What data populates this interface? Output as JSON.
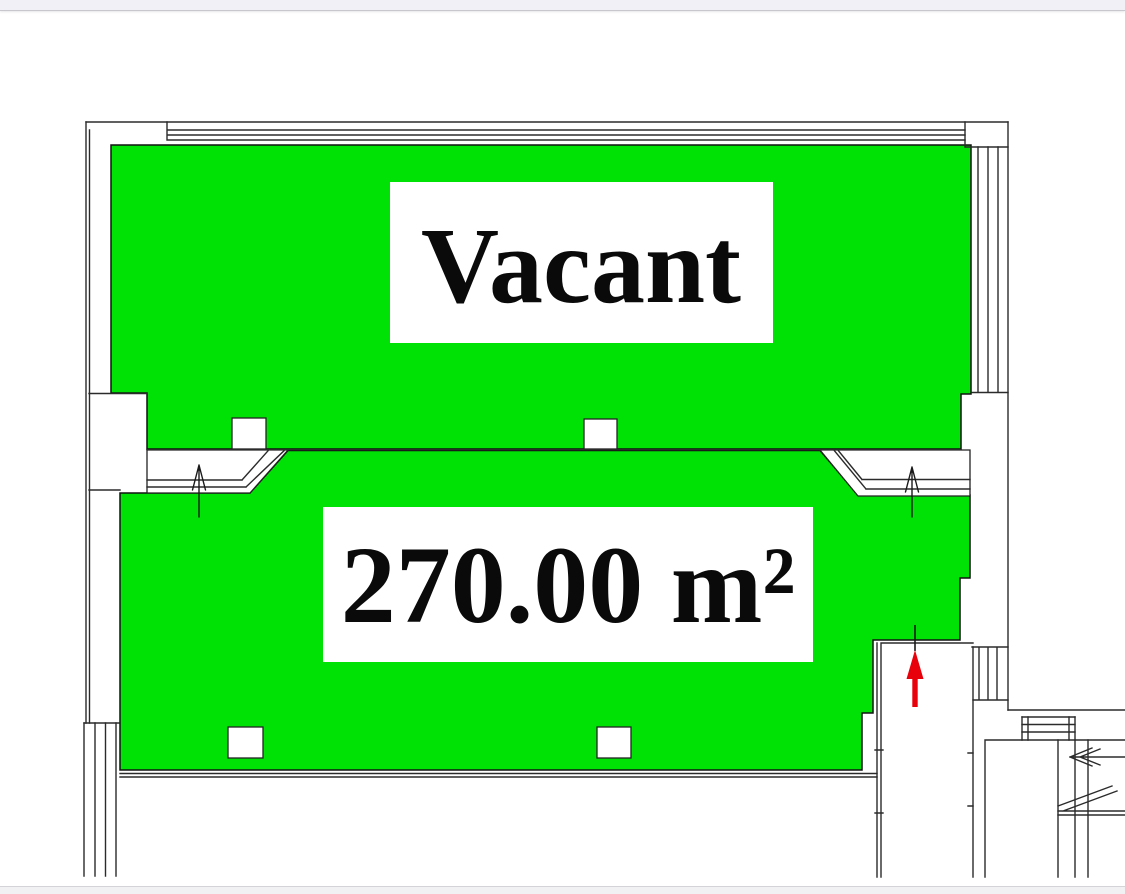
{
  "window": {
    "top_bar_color": "#f1f0f6",
    "bottom_bar_color": "#f1f1f4",
    "bar_border_color": "#c8c7ce"
  },
  "floor_plan": {
    "highlight_color": "#00e206",
    "room_outline_color": "#111111",
    "wall_color": "#2b2b2b",
    "entrance_arrow_color": "#e8000a",
    "units": [
      {
        "id": "vacant-suite",
        "label": "Vacant",
        "status": "Vacant"
      },
      {
        "id": "suite-area",
        "label": "270.00 m²",
        "area_m2": "270.00"
      }
    ],
    "icons": [
      "up-arrow-icon",
      "up-arrow-icon",
      "red-entrance-arrow-icon",
      "stair-direction-arrow-icon"
    ]
  }
}
